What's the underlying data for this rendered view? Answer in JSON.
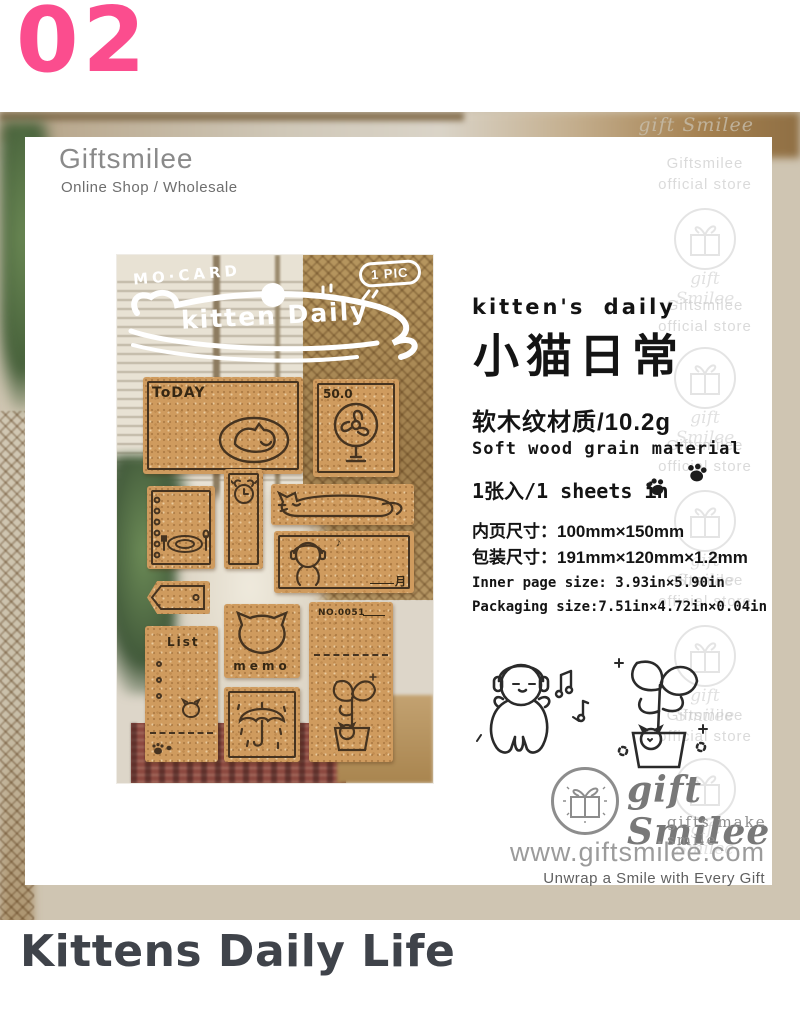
{
  "page": {
    "index_number": "02",
    "bottom_title": "Kittens Daily Life"
  },
  "panel": {
    "store_name": "Giftsmilee",
    "store_subtitle": "Online Shop / Wholesale",
    "watermark": {
      "line1": "Giftsmilee",
      "line2": "official store",
      "logo_text": "gift Smilee"
    }
  },
  "product_photo": {
    "overlay": {
      "brand": "MO·CARD",
      "title": "kitten Daily",
      "badge": "1 PIC"
    },
    "cards": {
      "today_label": "ToDAY",
      "fan_price": "50.0",
      "month_char": "月",
      "list_label": "List",
      "memo_label": "memo",
      "ticket_number": "NO.0051"
    }
  },
  "details": {
    "title_en": "kitten's daily",
    "title_zh": "小猫日常",
    "material_zh": "软木纹材质/10.2g",
    "material_en": "Soft wood grain material",
    "quantity": "1张入/1 sheets in",
    "inner_size_zh": "内页尺寸：100mm×150mm",
    "package_size_zh": "包装尺寸：191mm×120mm×1.2mm",
    "inner_size_en": "Inner page size: 3.93in×5.90in",
    "package_size_en": "Packaging size:7.51in×4.72in×0.04in"
  },
  "footer": {
    "logo_name": "gift Smilee",
    "logo_tagline": "gifts make smile",
    "website": "www.giftsmilee.com",
    "slogan": "Unwrap a Smile with Every Gift"
  },
  "colors": {
    "accent_pink": "#FB4D8E",
    "cork": "#CF9B5E",
    "ink_brown": "#453320",
    "title_gray": "#3F434A"
  }
}
